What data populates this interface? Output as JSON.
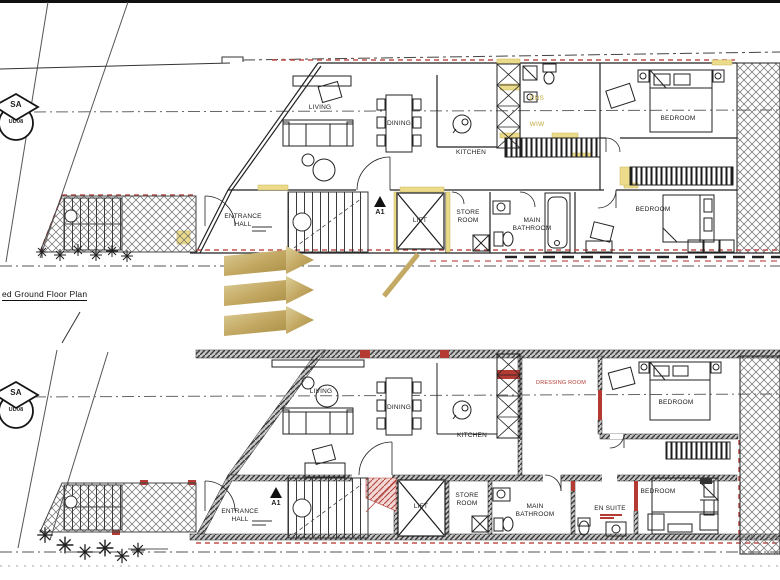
{
  "colors": {
    "accent_gold": "#C9AE66",
    "highlight_yellow": "#EBDB8A",
    "accent_red": "#B43B33",
    "ink": "#1C1C1C"
  },
  "caption": {
    "ground_plan": "ed Ground Floor Plan"
  },
  "site_markers": {
    "sa": "SA",
    "ud08": "UD08"
  },
  "section_marker": "A1",
  "plans": {
    "ground": {
      "rooms": {
        "living": "LIVING",
        "dining": "DINING",
        "kitchen": "KITCHEN",
        "ens": "ENS",
        "wiw": "WIW",
        "bedroom_top": "BEDROOM",
        "bedroom_mid": "BEDROOM",
        "entrance_hall": "ENTRANCE HALL",
        "lift": "LIFT",
        "store_room": "STORE ROOM",
        "main_bathroom": "MAIN BATHROOM"
      }
    },
    "first": {
      "rooms": {
        "living": "LIVING",
        "dining": "DINING",
        "kitchen": "KITCHEN",
        "dressing_room": "DRESSING ROOM",
        "bedroom_top": "BEDROOM",
        "bedroom_bottom": "BEDROOM",
        "entrance_hall": "ENTRANCE HALL",
        "lift": "LIFT",
        "store_room": "STORE ROOM",
        "main_bathroom": "MAIN BATHROOM",
        "en_suite": "EN SUITE"
      }
    }
  }
}
